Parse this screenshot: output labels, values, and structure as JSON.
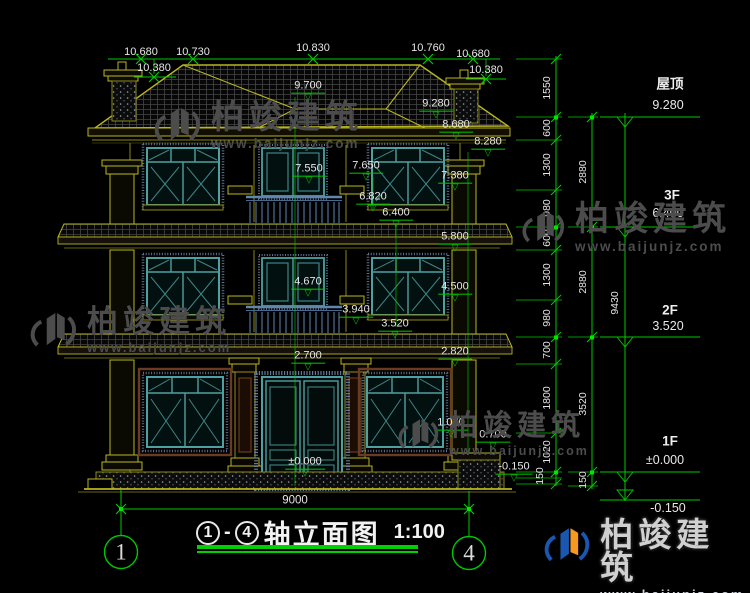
{
  "colors": {
    "background": "#000000",
    "line_yellow": "#b9b520",
    "line_green": "#00c800",
    "text_white": "#e6e6e6",
    "window_teal": "#4fa0a0",
    "frame_speckle_blue": "#6d87a6",
    "trim_brown": "#6a3a22",
    "watermark_gray": "#4c4c4c",
    "logo_blue": "#1a57b0",
    "logo_orange": "#f59a1f"
  },
  "watermark": {
    "brand": "柏竣建筑",
    "url": "www.baijunjz.com"
  },
  "title": {
    "axis_from": "1",
    "separator": "-",
    "axis_to": "4",
    "name": "轴立面图",
    "scale": "1:100"
  },
  "symbols": {
    "level_mark": "▽"
  },
  "labels": [
    {
      "c": "xdim",
      "t": "10.680",
      "x": 141,
      "y": 52,
      "n": "top-dim-10680-left"
    },
    {
      "c": "xdim",
      "t": "10.730",
      "x": 193,
      "y": 52,
      "n": "top-dim-10730"
    },
    {
      "c": "xdim",
      "t": "10.830",
      "x": 313,
      "y": 48,
      "n": "top-dim-10830"
    },
    {
      "c": "xdim",
      "t": "10.760",
      "x": 428,
      "y": 48,
      "n": "top-dim-10760"
    },
    {
      "c": "xdim",
      "t": "10.680",
      "x": 473,
      "y": 54,
      "n": "top-dim-10680-right"
    },
    {
      "c": "xdim",
      "t": "10.380",
      "x": 154,
      "y": 68,
      "n": "top-dim-10380-left"
    },
    {
      "c": "xdim",
      "t": "10.380",
      "x": 486,
      "y": 70,
      "n": "top-dim-10380-right"
    },
    {
      "c": "lvl",
      "t": "9.700",
      "x": 308,
      "y": 90,
      "n": "elev-9700"
    },
    {
      "c": "lvl",
      "t": "9.280",
      "x": 436,
      "y": 108,
      "n": "elev-9280"
    },
    {
      "c": "lvl",
      "t": "8.680",
      "x": 456,
      "y": 129,
      "n": "elev-8680"
    },
    {
      "c": "lvl",
      "t": "8.280",
      "x": 488,
      "y": 146,
      "n": "elev-8280"
    },
    {
      "c": "lvl",
      "t": "7.650",
      "x": 366,
      "y": 170,
      "n": "elev-7650"
    },
    {
      "c": "lvl",
      "t": "7.550",
      "x": 309,
      "y": 173,
      "n": "elev-7550"
    },
    {
      "c": "lvl",
      "t": "7.380",
      "x": 455,
      "y": 180,
      "n": "elev-7380"
    },
    {
      "c": "lvl",
      "t": "6.820",
      "x": 373,
      "y": 201,
      "n": "elev-6820"
    },
    {
      "c": "lvl",
      "t": "6.400",
      "x": 396,
      "y": 217,
      "n": "elev-6400"
    },
    {
      "c": "lvl",
      "t": "5.800",
      "x": 455,
      "y": 241,
      "n": "elev-5800"
    },
    {
      "c": "lvl",
      "t": "4.670",
      "x": 308,
      "y": 286,
      "n": "elev-4670"
    },
    {
      "c": "lvl",
      "t": "4.500",
      "x": 455,
      "y": 291,
      "n": "elev-4500"
    },
    {
      "c": "lvl",
      "t": "3.940",
      "x": 356,
      "y": 314,
      "n": "elev-3940"
    },
    {
      "c": "lvl",
      "t": "3.520",
      "x": 395,
      "y": 328,
      "n": "elev-3520"
    },
    {
      "c": "lvl",
      "t": "2.700",
      "x": 308,
      "y": 360,
      "n": "elev-2700"
    },
    {
      "c": "lvl",
      "t": "2.820",
      "x": 455,
      "y": 356,
      "n": "elev-2820"
    },
    {
      "c": "lvl",
      "t": "1.020",
      "x": 451,
      "y": 427,
      "n": "elev-1020"
    },
    {
      "c": "lvl",
      "t": "0.700",
      "x": 493,
      "y": 439,
      "n": "elev-0700"
    },
    {
      "c": "lvl",
      "t": "±0.000",
      "x": 305,
      "y": 466,
      "n": "elev-0000"
    },
    {
      "c": "lvl",
      "t": "-0.150",
      "x": 514,
      "y": 471,
      "n": "elev-minus0150"
    },
    {
      "c": "vdim",
      "t": "1550",
      "x": 548,
      "y": 88,
      "n": "chain-1550"
    },
    {
      "c": "vdim",
      "t": "600",
      "x": 548,
      "y": 128,
      "n": "chain-600-a"
    },
    {
      "c": "vdim",
      "t": "1300",
      "x": 548,
      "y": 165,
      "n": "chain-1300-a"
    },
    {
      "c": "vdim",
      "t": "980",
      "x": 548,
      "y": 208,
      "n": "chain-980-a"
    },
    {
      "c": "vdim",
      "t": "600",
      "x": 548,
      "y": 238,
      "n": "chain-600-b"
    },
    {
      "c": "vdim",
      "t": "1300",
      "x": 548,
      "y": 275,
      "n": "chain-1300-b"
    },
    {
      "c": "vdim",
      "t": "980",
      "x": 548,
      "y": 318,
      "n": "chain-980-b"
    },
    {
      "c": "vdim",
      "t": "700",
      "x": 548,
      "y": 350,
      "n": "chain-700"
    },
    {
      "c": "vdim",
      "t": "1800",
      "x": 548,
      "y": 398,
      "n": "chain-1800"
    },
    {
      "c": "vdim",
      "t": "1020",
      "x": 548,
      "y": 452,
      "n": "chain-1020"
    },
    {
      "c": "vdim",
      "t": "150",
      "x": 541,
      "y": 476,
      "n": "chain-150-a"
    },
    {
      "c": "vdim",
      "t": "2880",
      "x": 584,
      "y": 172,
      "n": "chain-2880-a"
    },
    {
      "c": "vdim",
      "t": "2880",
      "x": 584,
      "y": 282,
      "n": "chain-2880-b"
    },
    {
      "c": "vdim",
      "t": "3520",
      "x": 584,
      "y": 404,
      "n": "chain-3520"
    },
    {
      "c": "vdim",
      "t": "150",
      "x": 584,
      "y": 480,
      "n": "chain-150-b"
    },
    {
      "c": "vdim",
      "t": "9430",
      "x": 616,
      "y": 303,
      "n": "chain-9430"
    },
    {
      "c": "fname",
      "t": "屋顶",
      "x": 670,
      "y": 85,
      "n": "floor-label-roof"
    },
    {
      "c": "fval",
      "t": "9.280",
      "x": 668,
      "y": 106,
      "n": "floor-value-roof"
    },
    {
      "c": "fname",
      "t": "3F",
      "x": 672,
      "y": 196,
      "n": "floor-label-3f"
    },
    {
      "c": "fval",
      "t": "6.400",
      "x": 668,
      "y": 214,
      "n": "floor-value-3f"
    },
    {
      "c": "fname",
      "t": "2F",
      "x": 670,
      "y": 311,
      "n": "floor-label-2f"
    },
    {
      "c": "fval",
      "t": "3.520",
      "x": 668,
      "y": 327,
      "n": "floor-value-2f"
    },
    {
      "c": "fname",
      "t": "1F",
      "x": 670,
      "y": 442,
      "n": "floor-label-1f"
    },
    {
      "c": "fval",
      "t": "±0.000",
      "x": 665,
      "y": 461,
      "n": "floor-value-1f"
    },
    {
      "c": "fval",
      "t": "-0.150",
      "x": 668,
      "y": 509,
      "n": "floor-value-ground"
    },
    {
      "c": "bdim",
      "t": "9000",
      "x": 295,
      "y": 501,
      "n": "bottom-dim-9000"
    },
    {
      "c": "axisnum",
      "t": "1",
      "x": 121,
      "y": 552,
      "n": "axis-bubble-1"
    },
    {
      "c": "axisnum",
      "t": "4",
      "x": 469,
      "y": 553,
      "n": "axis-bubble-4"
    }
  ]
}
